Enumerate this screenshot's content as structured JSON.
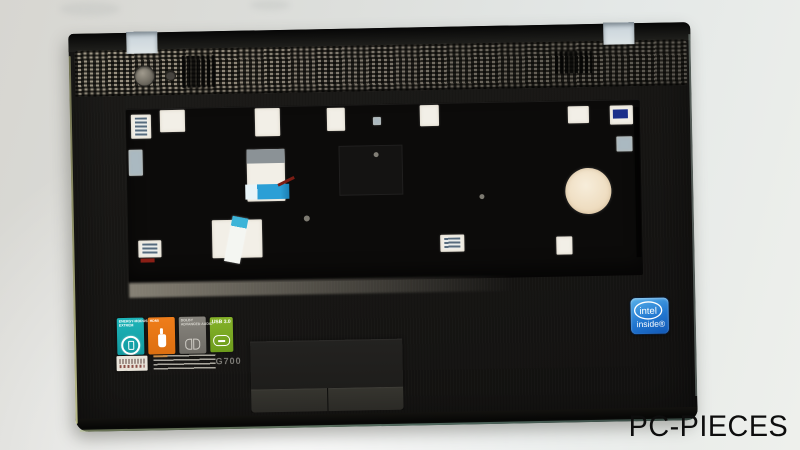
{
  "colors": {
    "sticker_energy": "#1db4b8",
    "sticker_hdmi": "#ef7d1a",
    "sticker_audio": "#87847d",
    "sticker_usb": "#85b229",
    "intel_blue": "#2277d0",
    "part_black": "#171614",
    "cutout_light": "#f2efe7",
    "ribbon_blue": "#2b9fd6"
  },
  "part": {
    "model_label": "G700"
  },
  "stickers": {
    "energy": {
      "line1": "ENERGY-MODUS",
      "line2": "EXTREM",
      "icon": "battery-circle-icon"
    },
    "hdmi": {
      "label": "HDMI",
      "icon": "hdmi-cable-icon"
    },
    "audio": {
      "line1": "DOLBY",
      "line2": "ADVANCED AUDIO",
      "icon": "dolby-icon"
    },
    "usb": {
      "label": "USB 3.0",
      "icon": "usb-plug-icon"
    }
  },
  "intel_badge": {
    "brand": "intel",
    "tagline": "inside®"
  },
  "watermark": "PC-PIECES"
}
